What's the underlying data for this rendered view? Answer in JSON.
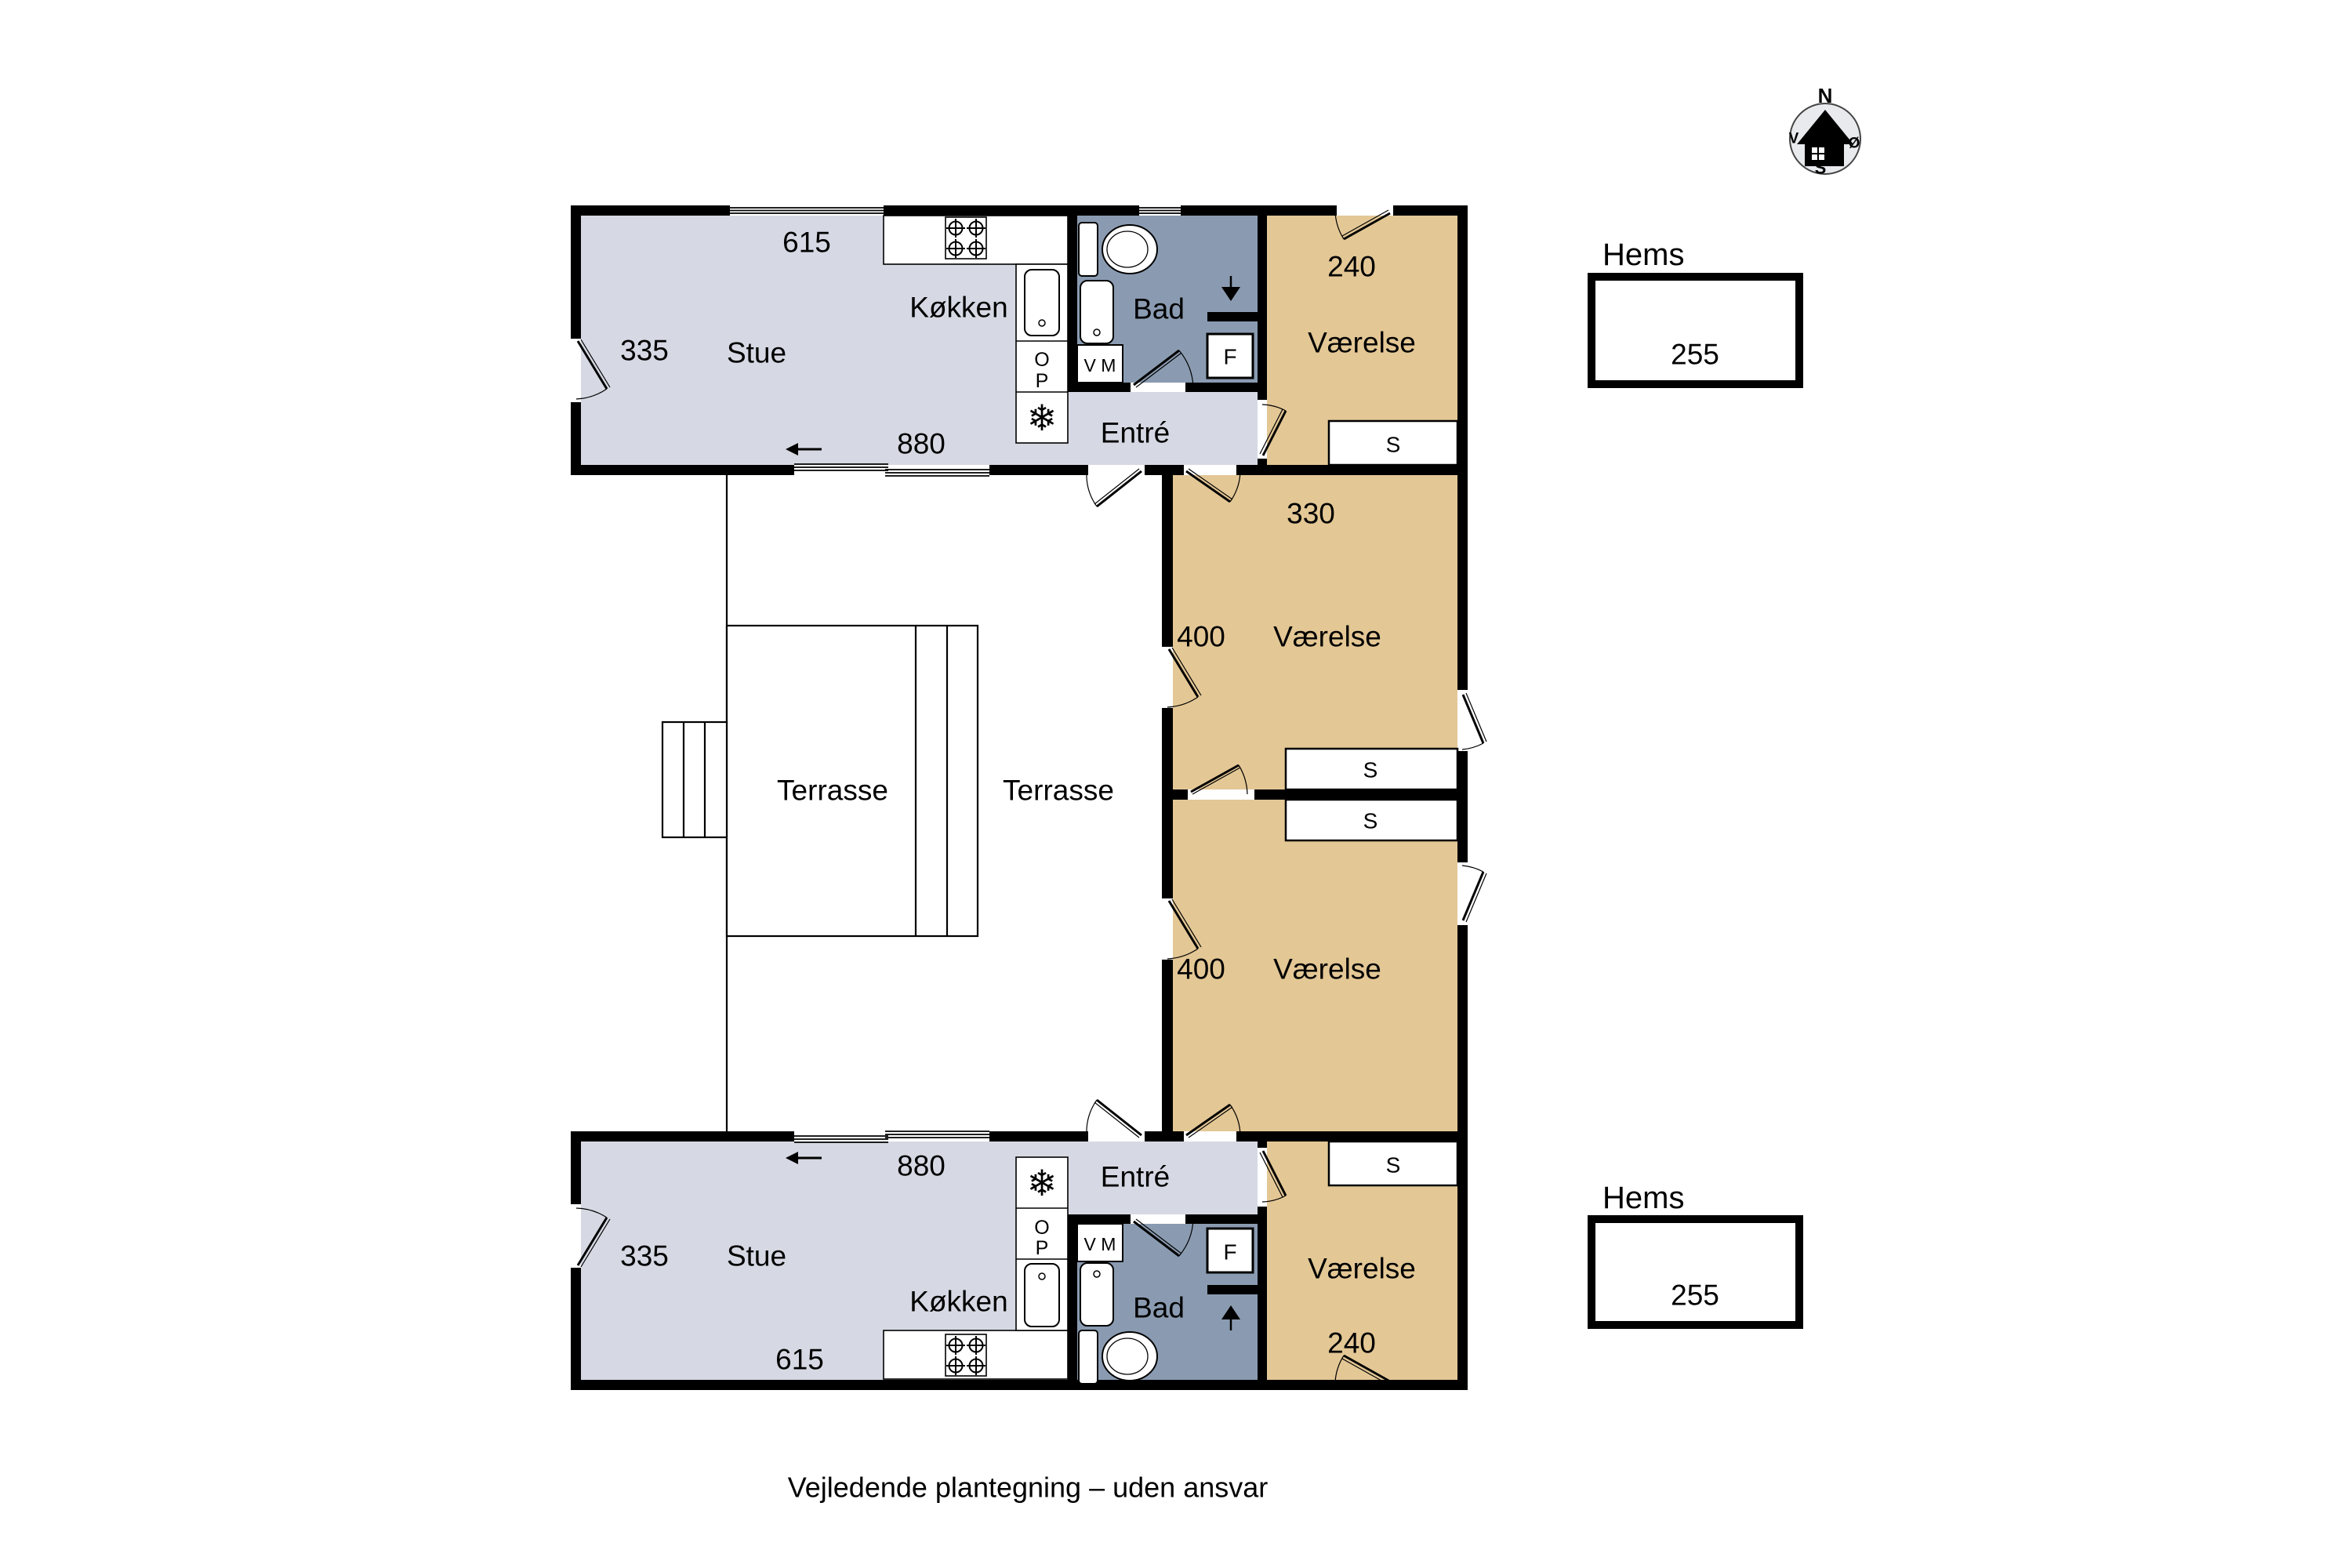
{
  "colors": {
    "floor_living": "#d6d9e3",
    "floor_bath": "#8a9bb1",
    "floor_bedroom": "#e3c795",
    "wall": "#000000",
    "background": "#ffffff",
    "compass_face": "#e8eaed"
  },
  "footer_note": "Vejledende plantegning – uden ansvar",
  "compass": {
    "north": "N",
    "east": "Ø",
    "south": "S",
    "west": "V"
  },
  "terrace": {
    "label_left": "Terrasse",
    "label_right": "Terrasse"
  },
  "unit_north": {
    "living_room": "Stue",
    "living_width": "335",
    "window_width": "615",
    "patio_width": "880",
    "kitchen": "Køkken",
    "bathroom": "Bad",
    "entry": "Entré",
    "bedroom": "Værelse",
    "bedroom_width": "240",
    "washing_machine": "V M",
    "fridge": "F",
    "oven_top": "O",
    "oven_bottom": "P",
    "wardrobe": "S"
  },
  "unit_south": {
    "living_room": "Stue",
    "living_width": "335",
    "window_width": "615",
    "patio_width": "880",
    "kitchen": "Køkken",
    "bathroom": "Bad",
    "entry": "Entré",
    "bedroom": "Værelse",
    "bedroom_width": "240",
    "washing_machine": "V M",
    "fridge": "F",
    "oven_top": "O",
    "oven_bottom": "P",
    "wardrobe": "S"
  },
  "middle_rooms": {
    "north_room": {
      "name": "Værelse",
      "width": "330",
      "depth": "400",
      "wardrobe": "S"
    },
    "south_room": {
      "name": "Værelse",
      "depth": "400",
      "wardrobe": "S"
    }
  },
  "hems_north": {
    "label": "Hems",
    "width": "255"
  },
  "hems_south": {
    "label": "Hems",
    "width": "255"
  },
  "icons": {
    "freezer": "❄"
  }
}
